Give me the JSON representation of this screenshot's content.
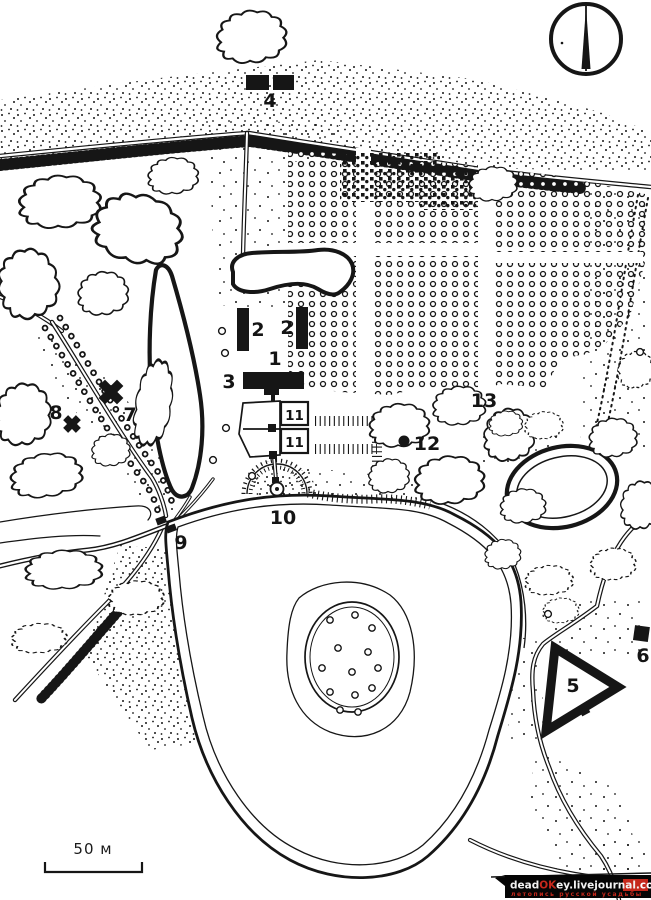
{
  "map": {
    "type": "estate-plan",
    "labels": [
      {
        "text": "1"
      },
      {
        "text": "2"
      },
      {
        "text": "2"
      },
      {
        "text": "3"
      },
      {
        "text": "4"
      },
      {
        "text": "5"
      },
      {
        "text": "6"
      },
      {
        "text": "7"
      },
      {
        "text": "8"
      },
      {
        "text": "9"
      },
      {
        "text": "10"
      },
      {
        "text": "11"
      },
      {
        "text": "11"
      },
      {
        "text": "12"
      },
      {
        "text": "13"
      }
    ],
    "scale": {
      "label": "50 м"
    },
    "watermark": {
      "dead": "dead",
      "ok": "OK",
      "mid": "ey.livejournal.",
      "com": "com",
      "tagline": "летопись русской усадьбы"
    },
    "colors": {
      "ink": "#151515",
      "paper": "#ffffff",
      "watermark_red": "#c5281c",
      "watermark_bg": "#050505"
    }
  }
}
